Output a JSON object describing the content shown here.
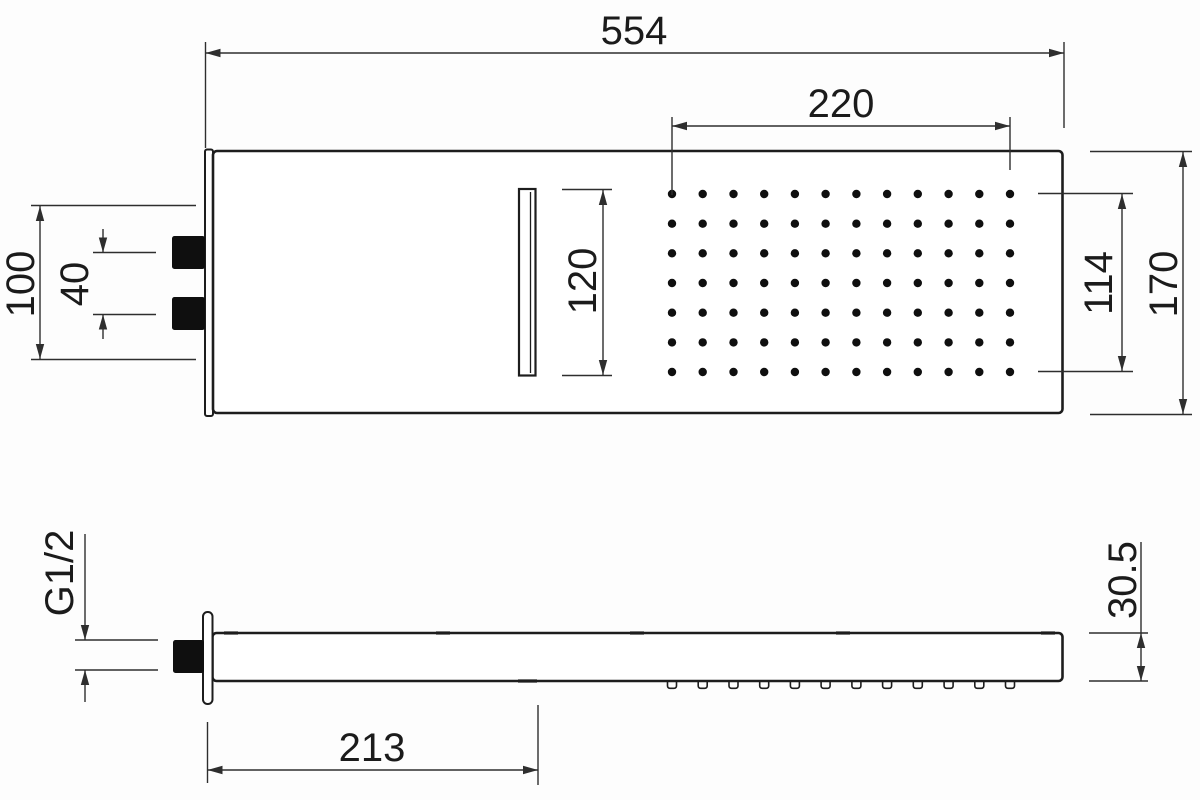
{
  "drawing_type": "technical-dimension-drawing",
  "views": {
    "plan": {
      "dimensions": {
        "overall_width": "554",
        "spray_field_width": "220",
        "inlet_span": "100",
        "inlet_spacing": "40",
        "slot_length": "120",
        "spray_field_height": "114",
        "overall_depth": "170"
      },
      "spray_grid": {
        "cols": 12,
        "rows": 7
      }
    },
    "side": {
      "dimensions": {
        "inlet_thread": "G1/2",
        "projection": "213",
        "thickness": "30.5"
      },
      "nozzle_count": 12
    }
  },
  "colors": {
    "line": "#1d1d1d",
    "dimension_line": "#2e2e2e",
    "text": "#1b1b1b",
    "connector_fill": "#0f0f0f",
    "background": "#fdfdfd"
  }
}
